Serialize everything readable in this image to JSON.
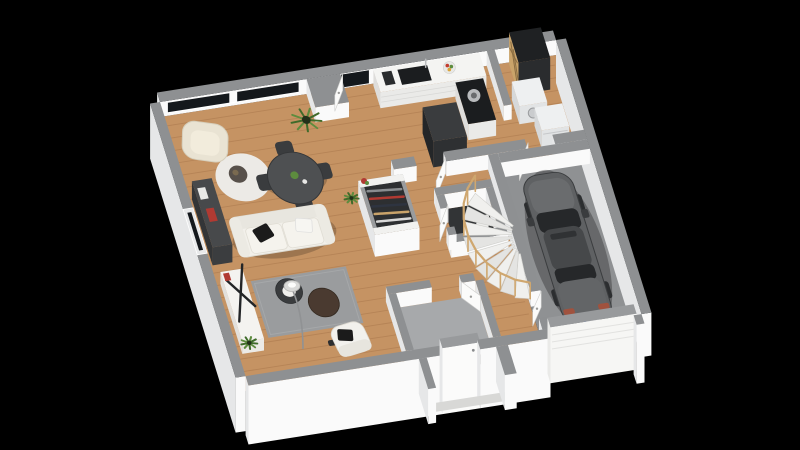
{
  "scene": {
    "title": "3D isometric floor plan render - ground floor of a house with attached garage",
    "view": "top-down isometric cutaway, black background",
    "rooms": [
      {
        "name": "living-dining-room",
        "floor": "light oak wood",
        "features": [
          "panoramic windows on north wall",
          "window on west wall"
        ]
      },
      {
        "name": "kitchen",
        "floor": "light oak wood",
        "features": [
          "L-shaped white counter",
          "black sink",
          "black cooktop",
          "black refrigerator",
          "fruit bowl"
        ]
      },
      {
        "name": "laundry-utility-room",
        "floor": "light oak wood",
        "features": [
          "black wine cabinet with wooden rack",
          "washing machine",
          "dryer"
        ]
      },
      {
        "name": "wc",
        "floor": "dark tile",
        "features": [
          "toilet"
        ]
      },
      {
        "name": "entry-vestibule",
        "floor": "grey tile",
        "features": [
          "front door",
          "outside porch slab"
        ]
      },
      {
        "name": "hallway",
        "floor": "light oak wood",
        "features": [
          "open wardrobe closet with hanging clothes",
          "winder staircase with wooden railing"
        ]
      },
      {
        "name": "garage",
        "floor": "grey concrete",
        "features": [
          "parked car",
          "white sectional garage door"
        ]
      }
    ],
    "furniture": [
      "cream armchair",
      "round white rug",
      "dark round side table",
      "dark wall sideboard",
      "round dark dining table",
      "4 dark dining chairs",
      "white three-seat sofa",
      "black pillow",
      "white pillow",
      "grey area rug",
      "black round coffee table with white tray",
      "walnut round coffee table",
      "arc floor lamp",
      "white tv bench with black X decor",
      "white armchair with black pillow",
      "potted grass plant",
      "small potted plants",
      "red flower plant on closet"
    ],
    "vehicle": {
      "type": "hatchback car seen from above",
      "color_name": "dark grey",
      "location": "garage",
      "license_plate": "white with blue EU band"
    }
  },
  "colors": {
    "bg": "#000000",
    "wallTop": "#8e9092",
    "wallTopLight": "#989a9c",
    "wallFace": "#fafafa",
    "wallShade": "#e6e7e8",
    "wood": "#c59363",
    "plank": "rgba(110,62,26,0.18)",
    "garageFloor": "#8f9193",
    "entryTile": "#a7a9ab",
    "porchFloor": "#939597",
    "wcFloor": "#323436",
    "glass": "#14181c",
    "counterTop": "#f4f4f2",
    "counterFace": "#eaeae8",
    "cooktop": "#1b1d1f",
    "steel": "#b9bbbd",
    "fridge": "#2e3032",
    "fridgeTop": "#3a3c3e",
    "wineBody": "#232527",
    "wineWood": "#c9a36a",
    "appliance": "#eef0f1",
    "sofa": "#f2f0ea",
    "sofaTrim": "#dbd8cf",
    "armchair": "#e9e3d3",
    "diningTable": "#4e5052",
    "chairDark": "#3a3c3e",
    "rugRound": "#eceae6",
    "rugGray": "#9a9c9e",
    "bench": "#f4f3f0",
    "sideboard": "#47494b",
    "closetInner": "#2d2f31",
    "doorWhite": "#fbfbfa",
    "stairTread": "#f0f0ee",
    "stairTreadAlt": "#e4e4e2",
    "stairRail": "#cfa76f",
    "carBody": "#5f6163",
    "carHood": "#6a6c6e",
    "carRoof": "#46484a",
    "carGlass": "#26282a",
    "carLight": "#a0523e",
    "plate": "#e9ebf5",
    "plateBand": "#3355bb",
    "plantGreen": "#5d8c3e",
    "plantDark": "#3f6b2a",
    "pillowBlack": "#1b1b1b",
    "pillowWhite": "#f7f6f2",
    "woodFurn": "#4a3a30",
    "redAccent": "#b13a32",
    "shadow": "rgba(0,0,0,0.20)"
  }
}
